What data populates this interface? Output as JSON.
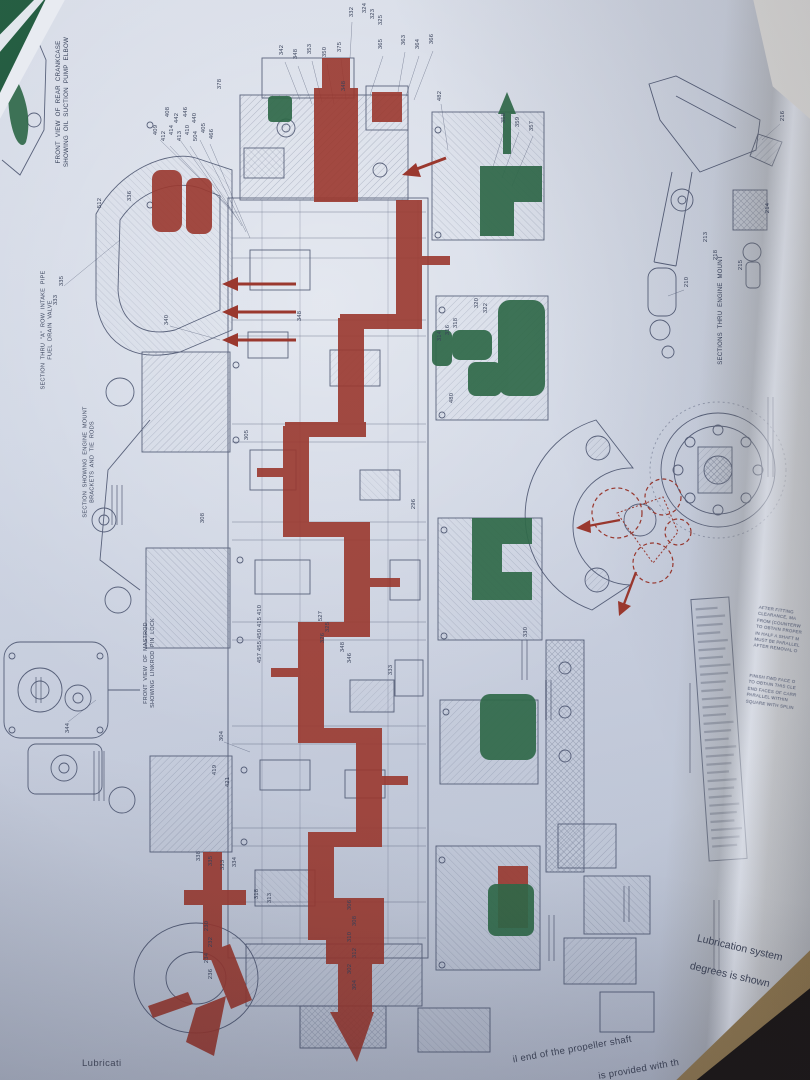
{
  "colors": {
    "oil_passage_red": "#9c3326",
    "highlight_green": "#2b6742",
    "ink_blue": "#3b445f",
    "paper_tint": "#ced4e0"
  },
  "page_text": {
    "bottom_left_partial": "Lubricati",
    "bottom_right_line1": "Lubrication system",
    "bottom_right_line2": "degrees is shown",
    "bottom_curve_line1": "il end of the propeller shaft",
    "bottom_curve_line2": "is provided with th"
  },
  "diagram": {
    "captions": [
      {
        "text": "FRONT  VIEW  OF  REAR  CRANKCASE\nSHOWING  OIL  SUCTION  PUMP  ELBOW",
        "x": 63,
        "y": 102,
        "rot": -90,
        "fs": 6.2
      },
      {
        "text": "SECTION  THRU  \"A\"  ROW  INTAKE  PIPE\nFUEL  DRAIN  VALVE",
        "x": 48,
        "y": 330,
        "rot": -90,
        "fs": 5.6
      },
      {
        "text": "SECTION  SHOWING  ENGINE  MOUNT\nBRACKETS  AND  TIE  RODS",
        "x": 90,
        "y": 462,
        "rot": -90,
        "fs": 5.6
      },
      {
        "text": "FRONT  VIEW  OF  MASTROD\nSHOWING  LINKROD  PIN  LOCK",
        "x": 150,
        "y": 663,
        "rot": -90,
        "fs": 5.4
      },
      {
        "text": "SECTIONS  THRU  ENGINE  MOUNT",
        "x": 722,
        "y": 310,
        "rot": -90,
        "fs": 6.0
      }
    ],
    "notes": [
      {
        "lines": [
          "AFTER  FITTING",
          "CLEARANCE,  MA",
          "FROM  (COUNTERW",
          "TO  OBTAIN  PROPER",
          "IN  HALF  A  SHAFT  M",
          "MUST  BE  PARALLEL",
          "AFTER  REMOVAL  O"
        ],
        "x": 779,
        "y": 630,
        "rot": 8,
        "fs": 4.4
      },
      {
        "lines": [
          "FINISH  FWD  FACE  O",
          "TO  OBTAIN  THIS  CLE",
          "END  FACES  OF  CARR",
          "PARALLEL  WITHIN",
          "SQUARE  WITH  SPLIN"
        ],
        "x": 772,
        "y": 692,
        "rot": 8,
        "fs": 4.4
      }
    ],
    "callouts": [
      {
        "t": "332",
        "x": 352,
        "y": 12
      },
      {
        "t": "324",
        "x": 365,
        "y": 8
      },
      {
        "t": "323",
        "x": 373,
        "y": 14
      },
      {
        "t": "325",
        "x": 381,
        "y": 20
      },
      {
        "t": "342",
        "x": 282,
        "y": 50
      },
      {
        "t": "348",
        "x": 296,
        "y": 54
      },
      {
        "t": "353",
        "x": 310,
        "y": 49
      },
      {
        "t": "350",
        "x": 325,
        "y": 52
      },
      {
        "t": "375",
        "x": 340,
        "y": 47
      },
      {
        "t": "365",
        "x": 381,
        "y": 44
      },
      {
        "t": "363",
        "x": 404,
        "y": 40
      },
      {
        "t": "364",
        "x": 418,
        "y": 44
      },
      {
        "t": "366",
        "x": 432,
        "y": 39
      },
      {
        "t": "378",
        "x": 220,
        "y": 84
      },
      {
        "t": "348",
        "x": 344,
        "y": 86
      },
      {
        "t": "482",
        "x": 440,
        "y": 96
      },
      {
        "t": "358",
        "x": 504,
        "y": 118
      },
      {
        "t": "359",
        "x": 518,
        "y": 122
      },
      {
        "t": "357",
        "x": 532,
        "y": 126
      },
      {
        "t": "408",
        "x": 168,
        "y": 112
      },
      {
        "t": "442",
        "x": 177,
        "y": 118
      },
      {
        "t": "446",
        "x": 186,
        "y": 112
      },
      {
        "t": "440",
        "x": 195,
        "y": 118
      },
      {
        "t": "409",
        "x": 156,
        "y": 130
      },
      {
        "t": "412",
        "x": 164,
        "y": 136
      },
      {
        "t": "414",
        "x": 172,
        "y": 130
      },
      {
        "t": "413",
        "x": 180,
        "y": 136
      },
      {
        "t": "410",
        "x": 188,
        "y": 130
      },
      {
        "t": "504",
        "x": 196,
        "y": 136
      },
      {
        "t": "405",
        "x": 204,
        "y": 128
      },
      {
        "t": "466",
        "x": 212,
        "y": 134
      },
      {
        "t": "512",
        "x": 100,
        "y": 203
      },
      {
        "t": "336",
        "x": 130,
        "y": 196
      },
      {
        "t": "335",
        "x": 62,
        "y": 281
      },
      {
        "t": "333",
        "x": 56,
        "y": 300
      },
      {
        "t": "340",
        "x": 167,
        "y": 320
      },
      {
        "t": "348",
        "x": 300,
        "y": 316
      },
      {
        "t": "314",
        "x": 440,
        "y": 336
      },
      {
        "t": "316",
        "x": 448,
        "y": 330
      },
      {
        "t": "318",
        "x": 456,
        "y": 323
      },
      {
        "t": "320",
        "x": 477,
        "y": 303
      },
      {
        "t": "322",
        "x": 486,
        "y": 308
      },
      {
        "t": "480",
        "x": 452,
        "y": 398
      },
      {
        "t": "305",
        "x": 247,
        "y": 435
      },
      {
        "t": "308",
        "x": 203,
        "y": 518
      },
      {
        "t": "296",
        "x": 414,
        "y": 504
      },
      {
        "t": "410",
        "x": 260,
        "y": 610
      },
      {
        "t": "415",
        "x": 260,
        "y": 622
      },
      {
        "t": "450",
        "x": 260,
        "y": 634
      },
      {
        "t": "455",
        "x": 260,
        "y": 646
      },
      {
        "t": "457",
        "x": 260,
        "y": 658
      },
      {
        "t": "527",
        "x": 321,
        "y": 616
      },
      {
        "t": "325",
        "x": 328,
        "y": 627
      },
      {
        "t": "326",
        "x": 323,
        "y": 638
      },
      {
        "t": "348",
        "x": 343,
        "y": 647
      },
      {
        "t": "346",
        "x": 350,
        "y": 658
      },
      {
        "t": "333",
        "x": 391,
        "y": 670
      },
      {
        "t": "330",
        "x": 526,
        "y": 632
      },
      {
        "t": "344",
        "x": 68,
        "y": 728
      },
      {
        "t": "304",
        "x": 222,
        "y": 736
      },
      {
        "t": "419",
        "x": 215,
        "y": 770
      },
      {
        "t": "421",
        "x": 228,
        "y": 782
      },
      {
        "t": "338",
        "x": 199,
        "y": 856
      },
      {
        "t": "335",
        "x": 211,
        "y": 861
      },
      {
        "t": "333",
        "x": 223,
        "y": 865
      },
      {
        "t": "334",
        "x": 235,
        "y": 862
      },
      {
        "t": "318",
        "x": 257,
        "y": 894
      },
      {
        "t": "313",
        "x": 270,
        "y": 898
      },
      {
        "t": "306",
        "x": 350,
        "y": 905
      },
      {
        "t": "308",
        "x": 355,
        "y": 921
      },
      {
        "t": "310",
        "x": 350,
        "y": 937
      },
      {
        "t": "312",
        "x": 355,
        "y": 953
      },
      {
        "t": "302",
        "x": 350,
        "y": 969
      },
      {
        "t": "304",
        "x": 355,
        "y": 985
      },
      {
        "t": "230",
        "x": 207,
        "y": 926
      },
      {
        "t": "232",
        "x": 211,
        "y": 942
      },
      {
        "t": "234",
        "x": 207,
        "y": 958
      },
      {
        "t": "236",
        "x": 211,
        "y": 974
      },
      {
        "t": "216",
        "x": 783,
        "y": 116
      },
      {
        "t": "214",
        "x": 768,
        "y": 208
      },
      {
        "t": "213",
        "x": 706,
        "y": 237
      },
      {
        "t": "218",
        "x": 716,
        "y": 255
      },
      {
        "t": "215",
        "x": 741,
        "y": 265
      },
      {
        "t": "210",
        "x": 687,
        "y": 282
      }
    ]
  }
}
